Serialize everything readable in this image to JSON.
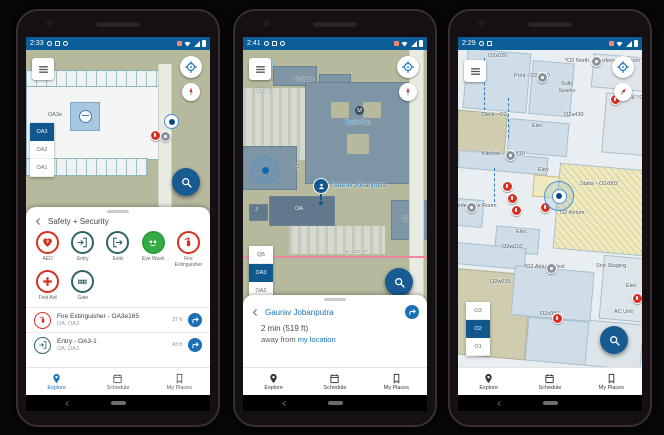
{
  "colors": {
    "status_bar": "#0b5d97",
    "accent_blue": "#11588e",
    "link_blue": "#1a75b8",
    "fab_blue": "#185a92",
    "alert_red": "#d83020",
    "safety_teal": "#2f6569",
    "eyewash_green": "#35ac46",
    "map_land": "#b6b99c",
    "indoor_room": "#cfdde8",
    "stairs_yellow": "#efe9c0"
  },
  "nav": {
    "explore": "Explore",
    "schedule": "Schedule",
    "my_places": "My Places"
  },
  "phones": [
    {
      "time": "2:33",
      "map": {
        "area_label": "OA3e",
        "floors": [
          "OA3",
          "OA2",
          "OA1"
        ]
      },
      "sheet": {
        "title": "Safety + Security",
        "categories": [
          {
            "label": "AED"
          },
          {
            "label": "Entry"
          },
          {
            "label": "Exits"
          },
          {
            "label": "Eye Wash"
          },
          {
            "label": "Fire Extinguisher"
          },
          {
            "label": "First Aid"
          },
          {
            "label": "Gate"
          }
        ],
        "results": [
          {
            "title": "Fire Extinguisher - OA3e165",
            "subtitle": "OA, OA3",
            "distance": "37 ft"
          },
          {
            "title": "Entry - OA3-1",
            "subtitle": "OA, OA3",
            "distance": "43 ft"
          }
        ]
      }
    },
    {
      "time": "2:41",
      "map": {
        "floors": [
          "QB",
          "OA3",
          "OA2"
        ],
        "labels": {
          "o_plant": "O Plant",
          "m_plant": "M Plant",
          "m_badge": "M",
          "turtle": "Turtle Pon",
          "o": "O",
          "oa": "OA",
          "j": "J",
          "q": "Q",
          "street": "W 41ST ST"
        },
        "person": "Gaurav Jobanputra"
      },
      "sheet": {
        "title": "Gaurav Jobanputra",
        "eta": "2 min (519 ft)",
        "away_text": "away from",
        "away_link": "my location"
      }
    },
    {
      "time": "2:29",
      "map": {
        "floors": [
          "O3",
          "O2",
          "O1"
        ],
        "labels": {
          "r1": "O2x020",
          "r2": "*O2 North A Conference Room",
          "r3": "Print - O2n010",
          "r4": "Sully Sparks",
          "r5": "Men's - O2a33",
          "r6": "Deck - O2",
          "r7": "O2a430",
          "r8": "Elec",
          "r9": "Kitchen - O2a510",
          "r10": "Elev",
          "r11": "Stairs - O2x002",
          "r12": "Conference Room",
          "r13": "O2 Atrium",
          "r14": "Elec",
          "r15": "O2w010",
          "r16": "*O2 Atrium West",
          "r17": "Srvr Staging",
          "r18": "O2w015",
          "r19": "O2x080",
          "r20": "AC Unit",
          "r21": "Elec"
        }
      }
    }
  ]
}
